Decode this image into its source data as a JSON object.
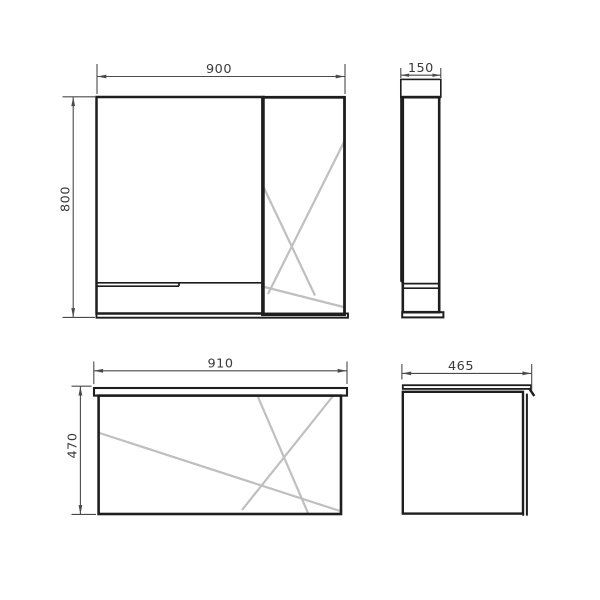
{
  "drawing": {
    "kind": "technical-dimension-drawing",
    "subject": "bathroom mirror cabinet and vanity unit, front and side orthographic views",
    "colors": {
      "background": "#ffffff",
      "outline": "#1e1e1e",
      "dimension_line": "#4a4a4a",
      "dimension_text": "#3a3a3a",
      "mirror_hatch": "#bfbfbf"
    },
    "views": [
      {
        "id": "mirror-cabinet-front",
        "position": "top-left",
        "features": [
          "open shelf compartment",
          "mirror door with reflection hatch",
          "bottom shelf band"
        ]
      },
      {
        "id": "mirror-cabinet-side",
        "position": "top-right",
        "features": [
          "top cap",
          "carcass",
          "shelf lines",
          "bottom cap"
        ]
      },
      {
        "id": "vanity-front",
        "position": "bottom-left",
        "features": [
          "countertop slab",
          "cabinet body with reflection hatch"
        ]
      },
      {
        "id": "vanity-side",
        "position": "bottom-right",
        "features": [
          "countertop with nose",
          "carcass",
          "front door panel"
        ]
      }
    ],
    "dims": {
      "mirror_width": "900",
      "mirror_depth": "150",
      "mirror_height": "800",
      "vanity_width": "910",
      "vanity_depth": "465",
      "vanity_height": "470"
    }
  }
}
